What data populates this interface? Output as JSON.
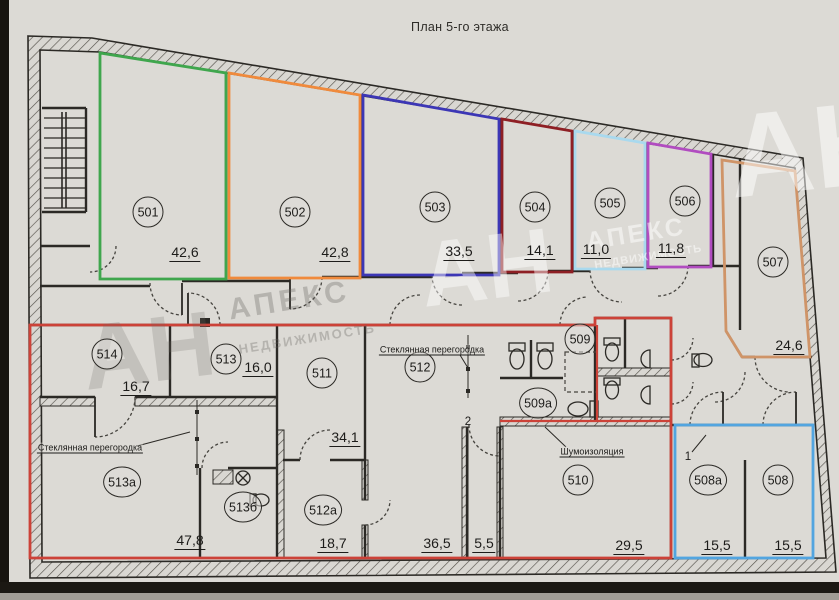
{
  "title": "План 5-го этажа",
  "watermark": {
    "an": "АН",
    "apeks": "АПЕКС",
    "nedv": "НЕДВИЖИМОСТЬ"
  },
  "annotations": {
    "glass_partition_center": "Стеклянная перегородка",
    "glass_partition_left": "Стеклянная перегородка",
    "soundproofing": "Шумоизоляция",
    "mark_1": "1",
    "mark_2": "2"
  },
  "unit_colors": {
    "u501": "#3fa64d",
    "u502": "#f08a3c",
    "u503": "#3c36b5",
    "u504": "#8e1f24",
    "u505": "#a9d9ee",
    "u506": "#b14cc0",
    "u507": "#cf9468",
    "u_block_red": "#cc4238",
    "u508": "#52a5e0"
  },
  "rooms": {
    "r501": {
      "number": "501",
      "area": "42,6"
    },
    "r502": {
      "number": "502",
      "area": "42,8"
    },
    "r503": {
      "number": "503",
      "area": "33,5"
    },
    "r504": {
      "number": "504",
      "area": "14,1"
    },
    "r505": {
      "number": "505",
      "area": "11,0"
    },
    "r506": {
      "number": "506",
      "area": "11,8"
    },
    "r507": {
      "number": "507",
      "area": "24,6"
    },
    "r508": {
      "number": "508",
      "area": "15,5"
    },
    "r508a": {
      "number": "508а",
      "area": "15,5"
    },
    "r509": {
      "number": "509"
    },
    "r509a": {
      "number": "509а"
    },
    "r510": {
      "number": "510",
      "area": "29,5"
    },
    "r511": {
      "number": "511",
      "area": "34,1"
    },
    "r512": {
      "number": "512",
      "area": "36,5"
    },
    "r512a": {
      "number": "512а",
      "area": "18,7"
    },
    "r513": {
      "number": "513",
      "area": "16,0"
    },
    "r513a": {
      "number": "513а",
      "area": "47,8"
    },
    "r513b": {
      "number": "513б"
    },
    "r514": {
      "number": "514",
      "area": "16,7"
    },
    "r_corridor": {
      "area": "5,5"
    }
  }
}
